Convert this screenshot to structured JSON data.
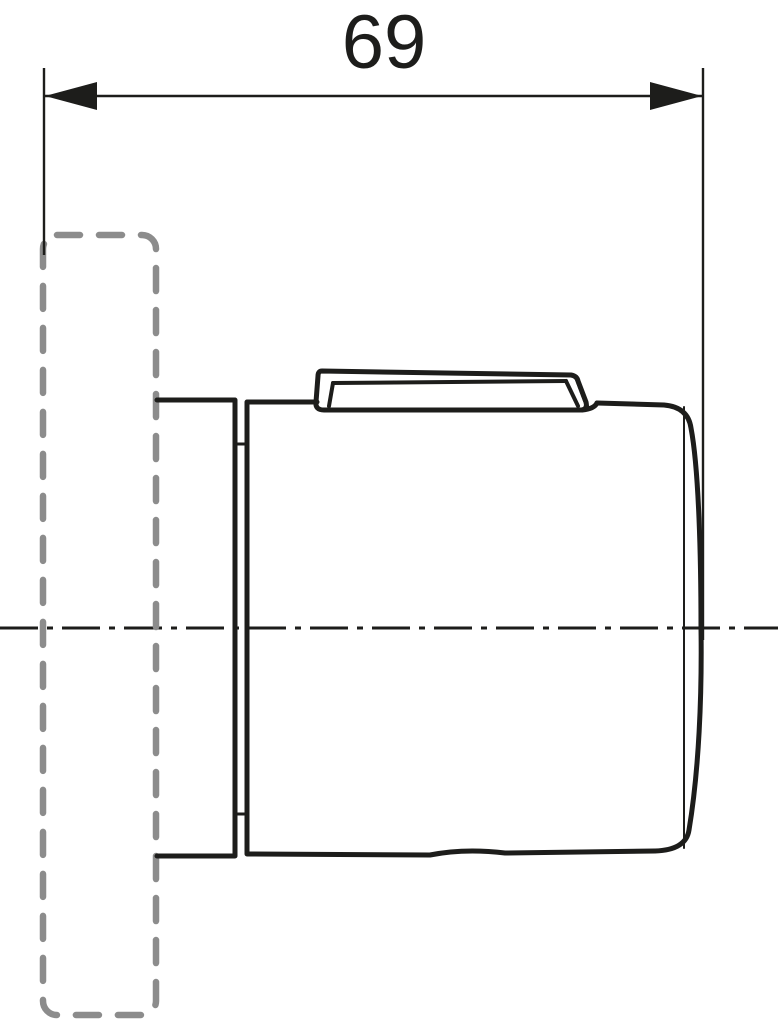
{
  "drawing": {
    "dimensions": [
      {
        "label": "69",
        "orientation": "horizontal"
      }
    ],
    "colors": {
      "ink": "#1d1d1b",
      "ghost": "#8c8c8c",
      "paper": "#ffffff"
    }
  }
}
